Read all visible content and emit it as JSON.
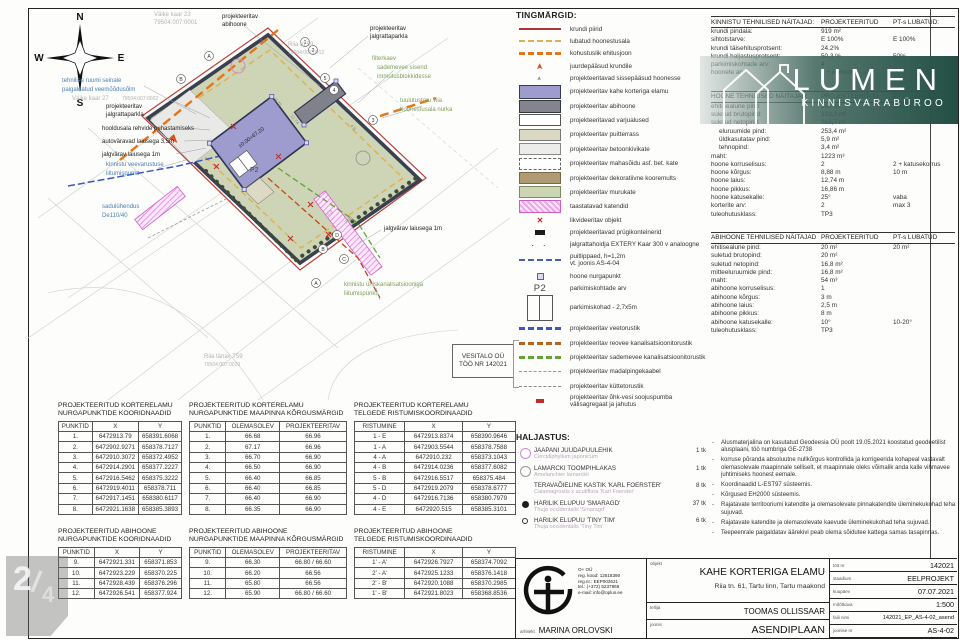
{
  "page": {
    "number": "2",
    "slash": "/",
    "total": "4"
  },
  "watermark": {
    "brand": "LUMEN",
    "sub": "KINNISVARABÜROO"
  },
  "plan": {
    "compass": {
      "n": "N",
      "e": "E",
      "s": "S",
      "w": "W"
    },
    "labels": {
      "abihoone1": "projekteeritav",
      "abihoone2": "abihoone",
      "kaar23_1": "Väike kaar 23",
      "kaar23_2": "79504:007:0001",
      "veemoodu1": "tehnilise ruumi seinale",
      "veemoodu2": "paigaldatud veemõõdusõlm",
      "kaar27_1": "Väike kaar 27",
      "kaar27_2": "79504:007:0002",
      "jp_left1": "projekteeritav",
      "jp_left2": "jalgrattaparkla",
      "hooldus": "hooldusala rehvide puhastamiseks",
      "autovarav": "autoväravad laiusega 3,5m",
      "jalgvarav1": "jalgvärav laiusega 1m",
      "veevarustus1": "kinnistu veevarustuse",
      "veevarustus2": "liitumispunkt",
      "sadul1": "sadulühendus",
      "sadul2": "De110/40",
      "jp_right1": "projekteeritav",
      "jp_right2": "jalgrattaparkla",
      "riia59_1": "Riia tn 59",
      "riia59_2": "79504:007:0012",
      "filter1": "filterkaev",
      "filter2": "sademevee sisend",
      "filter3": "immutusblokkidesse",
      "tuul1": "tuulutustoru viia",
      "tuul2": "hoonestusala nurka",
      "jalgvarav2": "jalgvärav laiusega 1m",
      "kanal1": "kinnistu ühiskanalisatsiooniga",
      "kanal2": "liitumispunkt",
      "riiaT59_1": "Riia tänav T59",
      "riiaT59_2": "79504:007:0029",
      "elevation": "±0.00=67.20",
      "p2": "P2"
    },
    "dims": {
      "d1": "12.74",
      "d2": "8.75",
      "d3": "4.5",
      "d4": "7.98",
      "d5": "5.9"
    },
    "axis": {
      "a_top": "A",
      "b_top": "B",
      "n1": "1",
      "n2": "2",
      "n3": "3",
      "n4": "4",
      "n5": "5",
      "d_bot": "D",
      "b_bot": "B",
      "c_bot": "C",
      "a_bot": "A"
    }
  },
  "legend": {
    "title": "TINGMÄRGID:",
    "items": [
      {
        "sw": "line-red",
        "rh": "rh-s",
        "label": "krundi piirid"
      },
      {
        "sw": "line-yellow-dash",
        "rh": "rh-s",
        "label": "lubatud hoonestusala"
      },
      {
        "sw": "line-orange-dash",
        "rh": "rh-s",
        "label": "kohustuslik ehitusjoon"
      },
      {
        "sw": "arrow-orange",
        "rh": "rh-s",
        "label": "juurdepääsud krundile"
      },
      {
        "sw": "arrow-small",
        "rh": "rh-s",
        "label": "projekteeritavad sissepääsud hoonesse"
      },
      {
        "sw": "box-purple",
        "rh": "rh-m",
        "label": "projekteeritav kahe korteriga elamu"
      },
      {
        "sw": "box-gray",
        "rh": "rh-m",
        "label": "projekteeritav abihoone"
      },
      {
        "sw": "box-white",
        "rh": "rh-m",
        "label": "projekteeritavad varjualused"
      },
      {
        "sw": "box-wood",
        "rh": "rh-m",
        "label": "projekteeritav puitterrass"
      },
      {
        "sw": "box-concrete",
        "rh": "rh-m",
        "label": "projekteeritav betoonkivikate"
      },
      {
        "sw": "box-dashed",
        "rh": "rh-m",
        "label": "projekteeritav mahasõidu asf. bet. kate"
      },
      {
        "sw": "box-mulch",
        "rh": "rh-m",
        "label": "projekteeritav dekoratiivne kooremults"
      },
      {
        "sw": "box-grass",
        "rh": "rh-m",
        "label": "projekteeritav murukate"
      },
      {
        "sw": "box-pink-hatch",
        "rh": "rh-m",
        "label": "taastatavad katendid"
      },
      {
        "sw": "x-red",
        "rh": "rh-s",
        "label": "likvideeritav objekt"
      },
      {
        "sw": "trash",
        "rh": "rh-s",
        "label": "projekteeritavad prügikonteinerid"
      },
      {
        "sw": "bike",
        "rh": "rh-s",
        "label": "jalgrattahoidja EXTERY Kaar 300 v analoogne"
      },
      {
        "sw": "line-fence",
        "rh": "rh-f",
        "label": "puitlippaed, h=1,2m",
        "label2": "vt. joonis AS-4-04"
      },
      {
        "sw": "corner-pt",
        "rh": "rh-s",
        "label": "hoone nurgapunkt"
      },
      {
        "sw": "p2",
        "rh": "rh-s",
        "label": "parkimiskohtade arv",
        "text": "P2"
      },
      {
        "sw": "parking",
        "rh": "rh-p",
        "label": "parkimiskohad - 2,7x5m"
      },
      {
        "sw": "pipe-blue",
        "rh": "rh-m",
        "label": "projekteeritav veetorustik"
      },
      {
        "sw": "pipe-brown",
        "rh": "rh-m",
        "label": "projekteeritav reovee kanalisatsioonitorustik"
      },
      {
        "sw": "pipe-green",
        "rh": "rh-m",
        "label": "projekteeritav sademevee kanalisatsioonitorustik"
      },
      {
        "sw": "pipe-gray",
        "rh": "rh-m",
        "label": "projekteeritav madalpingekaabel"
      },
      {
        "sw": "pipe-dashdot",
        "rh": "rh-m",
        "label": "projekteeritav küttetorustik"
      },
      {
        "sw": "hp-red",
        "rh": "rh-m",
        "label": "projekteeritav õhk-vesi soojuspumba välisagregaat ja jahutus"
      }
    ]
  },
  "vesitalo": {
    "line1": "VESITALO OÜ",
    "line2": "TÖÖ NR 142021"
  },
  "rtables": {
    "kinnistu": {
      "title": "KINNISTU TEHNILISED NÄITAJAD:",
      "col1": "PROJEKTEERITUD",
      "col2": "PT-s LUBATUD:",
      "rows": [
        {
          "label": "krundi pindala:",
          "proj": "919 m²",
          "lub": ""
        },
        {
          "label": "sihtotstarve:",
          "proj": "E 100%",
          "lub": "E 100%"
        },
        {
          "label": "krundi täisehitusprotsent:",
          "proj": "24.2%",
          "lub": ""
        },
        {
          "label": "krundi haljastusprotsent:",
          "proj": "50.3 %",
          "lub": "50%"
        },
        {
          "label": "parkimiskohtade arv:",
          "proj": "4",
          "lub": ""
        },
        {
          "label": "hoonete arv:",
          "proj": "1 + abihoone",
          "lub": ""
        }
      ]
    },
    "hoone": {
      "title": "HOONE TEHNILISED NÄITAJAD:",
      "col1": "PROJEKTEERITUD",
      "col2": "PT-s LUBATUD",
      "rows": [
        {
          "label": "ehitisealune pind:",
          "proj": "180 m²",
          "lub": "180 m²"
        },
        {
          "label": "suletud brutopind:",
          "proj": "333,3 m²",
          "lub": ""
        },
        {
          "label": "suletud netopind:",
          "proj": "262,7 m²",
          "lub": ""
        },
        {
          "label": "eluruumide pind:",
          "proj": "253,4 m²",
          "lub": "",
          "ind": "indent"
        },
        {
          "label": "üldkasutatav pind:",
          "proj": "5,9 m²",
          "lub": "",
          "ind": "indent"
        },
        {
          "label": "tehnopind:",
          "proj": "3,4 m²",
          "lub": "",
          "ind": "indent"
        },
        {
          "label": "maht:",
          "proj": "1223 m³",
          "lub": ""
        },
        {
          "label": "hoone korruselisus:",
          "proj": "2",
          "lub": "2 + katusekorrus"
        },
        {
          "label": "hoone kõrgus:",
          "proj": "8,88 m",
          "lub": "10 m"
        },
        {
          "label": "hoone laius:",
          "proj": "12,74 m",
          "lub": ""
        },
        {
          "label": "hoone pikkus:",
          "proj": "16,86 m",
          "lub": ""
        },
        {
          "label": "hoone katusekalle:",
          "proj": "25°",
          "lub": "vaba"
        },
        {
          "label": "korterite arv:",
          "proj": "2",
          "lub": "max 3"
        },
        {
          "label": "tuleohutusklass:",
          "proj": "TP3",
          "lub": ""
        }
      ]
    },
    "abihoone": {
      "title": "ABIHOONE TEHNILISED NÄITAJAD",
      "col1": "PROJEKTEERITUD",
      "col2": "PT-s LUBATUD",
      "rows": [
        {
          "label": "ehitisealune pind:",
          "proj": "20 m²",
          "lub": "20 m²"
        },
        {
          "label": "suletud brutopind:",
          "proj": "20 m²",
          "lub": ""
        },
        {
          "label": "suletud netopind:",
          "proj": "16,8 m²",
          "lub": ""
        },
        {
          "label": "mitteeluruumide pind:",
          "proj": "16,8 m²",
          "lub": ""
        },
        {
          "label": "maht:",
          "proj": "54 m³",
          "lub": ""
        },
        {
          "label": "abihoone korruselisus:",
          "proj": "1",
          "lub": ""
        },
        {
          "label": "abihoone kõrgus:",
          "proj": "3 m",
          "lub": ""
        },
        {
          "label": "abihoone laius:",
          "proj": "2,5 m",
          "lub": ""
        },
        {
          "label": "abihoone pikkus:",
          "proj": "8 m",
          "lub": ""
        },
        {
          "label": "abihoone katusekalle:",
          "proj": "10°",
          "lub": "10-20°"
        },
        {
          "label": "tuleohutusklass:",
          "proj": "TP3",
          "lub": ""
        }
      ]
    }
  },
  "haljastus": {
    "title": "HALJASTUS:",
    "items": [
      {
        "icon": "tree-circle-pink",
        "name": "JAAPANI JUUDAPUULEHIK",
        "latin": "Cercidiphyllum japonicum",
        "count": "1 tk"
      },
      {
        "icon": "tree-circle-gray",
        "name": "LAMARCKI TOOMPIHLAKAS",
        "latin": "Amelanchier lamarckii",
        "count": "1 tk"
      },
      {
        "icon": "icon-none",
        "name": "TERAVAÕIELINE KASTIK 'KARL FOERSTER'",
        "latin": "Calamagrostis x acutiflora 'Karl Foerster'",
        "count": "8 tk"
      },
      {
        "icon": "dot-filled",
        "name": "HARILIK ELUPUU 'SMARAGD'",
        "latin": "Thuja occidentalis 'Smaragd'",
        "count": "37 tk"
      },
      {
        "icon": "dot-small",
        "name": "HARILIK ELUPUU 'TINY TIM'",
        "latin": "Thuja occidentalis 'Tiny Tim'",
        "count": "6 tk"
      }
    ]
  },
  "notes": [
    "Alusmaterjalina on kasutatud Geodeesia OÜ poolt 19.05.2021 koostatud geodeetilist alusplaani, töö numbriga GE-2738",
    "korruse põranda absoluutne nullkõrgus kontrollida ja korrigeerida kohapeal vastavalt olemasolevale maapinnale selliselt, et maapinnale oleks võimalik anda kalle vihmavee juhtimiseks hoonest eemale.",
    "Koordinaadid L-EST97 süsteemis.",
    "Kõrgused EH2000 süsteemis.",
    "Rajatavate territooriumi katendite ja olemasolevate pinnakatendite üleminekukohad teha sujuvad.",
    "Rajatavate katendite ja olemasolevate kaevude üleminekukohad teha sujuvad.",
    "Teepeenrale paigaldatav äärekivi peab olema sõidutee kattega samas tasapinnas."
  ],
  "coord_tables": {
    "t1": {
      "title1": "PROJEKTEERITUD KORTERELAMU",
      "title2": "NURGAPUNKTIDE KOORIDNAADID",
      "headers": [
        "PUNKTID",
        "X",
        "Y"
      ],
      "rows": [
        [
          "1.",
          "6472913.79",
          "658391.6068"
        ],
        [
          "2.",
          "6472902.9271",
          "658378.7127"
        ],
        [
          "3.",
          "6472910.3072",
          "658372.4952"
        ],
        [
          "4.",
          "6472914.2901",
          "658377.2227"
        ],
        [
          "5.",
          "6472916.5462",
          "658375.3222"
        ],
        [
          "6.",
          "6472919.4011",
          "658378.711"
        ],
        [
          "7.",
          "6472917.1451",
          "658380.6117"
        ],
        [
          "8.",
          "6472921.1638",
          "658385.3893"
        ]
      ]
    },
    "t2": {
      "title1": "PROJEKTEERITUD KORTERELAMU",
      "title2": "NURGAPUNKTIDE MAAPINNA KÕRGUSMÄRGID",
      "headers": [
        "PUNKTID",
        "OLEMASOLEV",
        "PROJEKTEERITAV"
      ],
      "rows": [
        [
          "1.",
          "66.68",
          "66.96"
        ],
        [
          "2.",
          "67.17",
          "66.96"
        ],
        [
          "3.",
          "66.70",
          "66.90"
        ],
        [
          "4.",
          "66.50",
          "66.90"
        ],
        [
          "5.",
          "66.40",
          "66.85"
        ],
        [
          "6.",
          "66.40",
          "66.85"
        ],
        [
          "7.",
          "66.40",
          "66.90"
        ],
        [
          "8.",
          "66.35",
          "66.90"
        ]
      ]
    },
    "t3": {
      "title1": "PROJEKTEERITUD KORTERELAMU",
      "title2": "TELGEDE RISTUMISKOORDINAADID",
      "headers": [
        "RISTUMINE",
        "X",
        "Y"
      ],
      "rows": [
        [
          "1 - E",
          "6472913.8374",
          "658390.9646"
        ],
        [
          "1 - A",
          "6472903.5544",
          "658378.7588"
        ],
        [
          "4 - A",
          "6472910.232",
          "658373.1043"
        ],
        [
          "4 - B",
          "6472914.0236",
          "658377.6082"
        ],
        [
          "5 - B",
          "6472916.5517",
          "658375.484"
        ],
        [
          "5 - D",
          "6472919.2079",
          "658378.6777"
        ],
        [
          "4 - D",
          "6472916.7136",
          "658380.7979"
        ],
        [
          "4 - E",
          "6472920.515",
          "658385.3101"
        ]
      ]
    },
    "t4": {
      "title1": "PROJEKTEERITUD ABIHOONE",
      "title2": "NURGAPUNKTIDE KOORIDNAADID",
      "headers": [
        "PUNKTID",
        "X",
        "Y"
      ],
      "rows": [
        [
          "9.",
          "6472921.331",
          "658371.853"
        ],
        [
          "10.",
          "6472923.229",
          "658370.225"
        ],
        [
          "11.",
          "6472928.439",
          "658376.296"
        ],
        [
          "12.",
          "6472926.541",
          "658377.924"
        ]
      ]
    },
    "t5": {
      "title1": "PROJEKTEERITUD ABIHOONE",
      "title2": "NURGAPUNKTIDE MAAPINNA KÕRGUSMÄRGID",
      "headers": [
        "PUNKTID",
        "OLEMASOLEV",
        "PROJEKTEERITAV"
      ],
      "rows": [
        [
          "9.",
          "66.30",
          "66.80 / 66.60"
        ],
        [
          "10.",
          "66.20",
          "66.56"
        ],
        [
          "11.",
          "65.80",
          "66.56"
        ],
        [
          "12.",
          "65.90",
          "66.80 / 66.60"
        ]
      ]
    },
    "t6": {
      "title1": "PROJEKTEERITUD ABIHOONE",
      "title2": "TELGEDE RISTUMISKOORDINAADID",
      "headers": [
        "RISTUMINE",
        "X",
        "Y"
      ],
      "rows": [
        [
          "1' - A'",
          "6472926.7927",
          "658374.7092"
        ],
        [
          "2' - A'",
          "6472925.1233",
          "658376.1418"
        ],
        [
          "2' - B'",
          "6472920.1088",
          "658370.2985"
        ],
        [
          "1' - B'",
          "6472921.8023",
          "658368.8536"
        ]
      ]
    }
  },
  "titleblock": {
    "company_lines": [
      "O+ OÜ",
      "reg. kood: 12518390",
      "reg.nr.: EEP002621",
      "tel.: (+372) 5237968",
      "e-mail: info@oplus.ee"
    ],
    "arhitekt_label": "arhitekt",
    "arhitekt": "MARINA ORLOVSKI",
    "objekt_label": "objekt",
    "objekt": "KAHE KORTERIGA ELAMU",
    "objekt_sub": "Riia tn. 61, Tartu linn, Tartu maakond",
    "tellija_label": "tellija",
    "tellija": "TOOMAS OLLISSAAR",
    "joonis_label": "joonis",
    "joonis": "ASENDIPLAAN",
    "meta": [
      {
        "label": "töö nr",
        "value": "142021"
      },
      {
        "label": "staadium",
        "value": "EELPROJEKT"
      },
      {
        "label": "kuupäev",
        "value": "07.07.2021"
      },
      {
        "label": "mõõtkava",
        "value": "1:500"
      },
      {
        "label": "faili nimi",
        "value": "142021_EP_AS-4-02_asend",
        "small": "small"
      },
      {
        "label": "joonise nr",
        "value": "AS-4-02"
      }
    ]
  }
}
